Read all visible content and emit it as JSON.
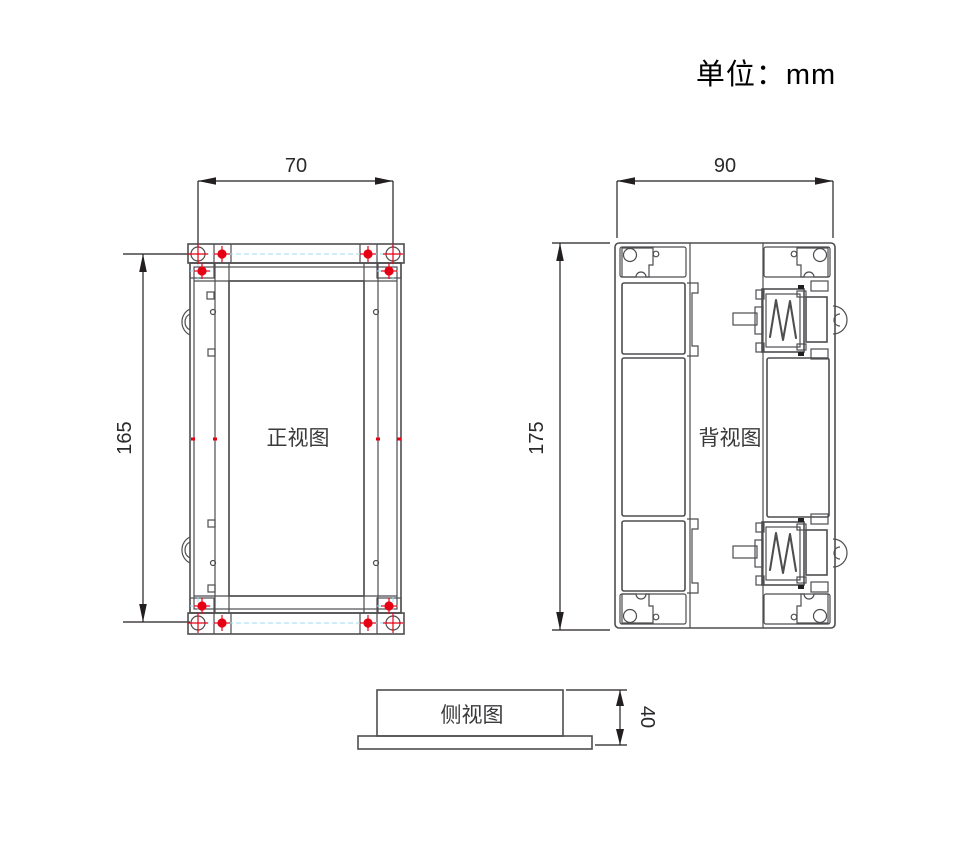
{
  "title": "单位：mm",
  "colors": {
    "line": "#4e4e50",
    "dim": "#231f20",
    "red": "#e60014",
    "cyan": "#9fdbf3",
    "background": "#ffffff"
  },
  "views": {
    "front": {
      "label": "正视图",
      "width_mm": "70",
      "height_mm": "165"
    },
    "back": {
      "label": "背视图",
      "width_mm": "90",
      "height_mm": "175"
    },
    "side": {
      "label": "侧视图",
      "height_mm": "40"
    }
  }
}
